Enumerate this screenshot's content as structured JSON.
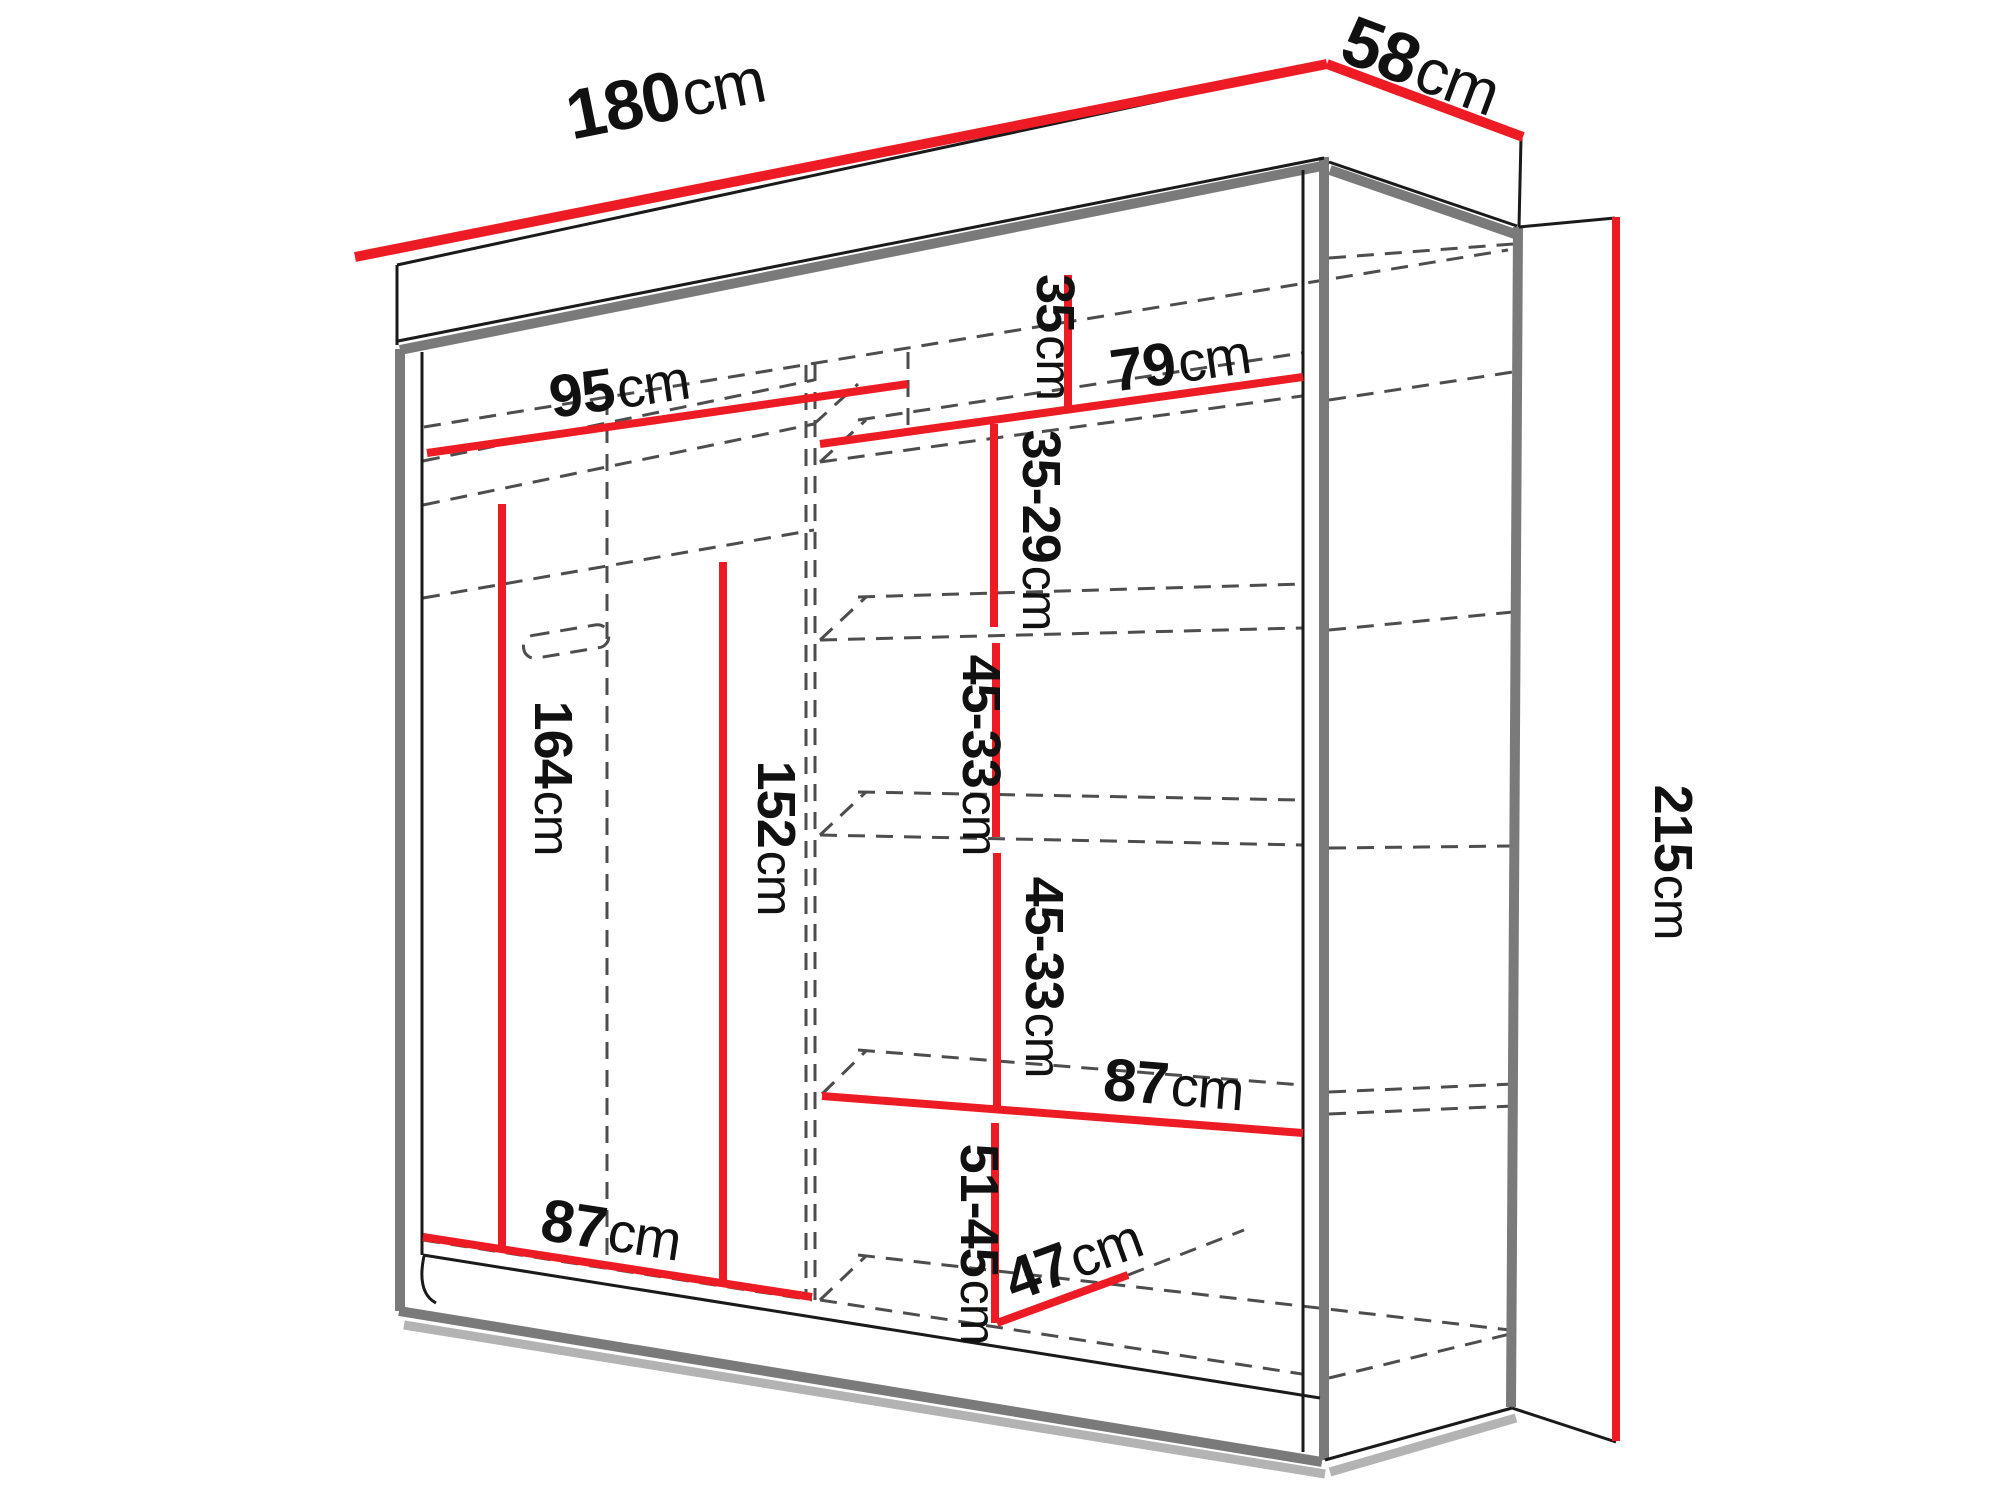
{
  "diagram": {
    "type": "furniture-dimension-drawing",
    "subject": "sliding-door wardrobe with interior shelves and hanging rails",
    "unit": "cm",
    "colors": {
      "dimension_line": "#ed1c24",
      "outline": "#1a1a1a",
      "panel_trim": "#7a7a7a",
      "hidden_edge": "#4d4d4d",
      "background": "#ffffff"
    },
    "dimensions": {
      "overall_width": {
        "num": "180",
        "unit": "cm"
      },
      "overall_depth": {
        "num": "58",
        "unit": "cm"
      },
      "overall_height": {
        "num": "215",
        "unit": "cm"
      },
      "left_section_width": {
        "num": "95",
        "unit": "cm"
      },
      "right_top_shelf_width": {
        "num": "79",
        "unit": "cm"
      },
      "right_top_height": {
        "num": "35",
        "unit": "cm"
      },
      "right_gap_upper": {
        "num": "35-29",
        "unit": "cm"
      },
      "right_gap_mid_1": {
        "num": "45-33",
        "unit": "cm"
      },
      "right_gap_mid_2": {
        "num": "45-33",
        "unit": "cm"
      },
      "right_shelf_width": {
        "num": "87",
        "unit": "cm"
      },
      "right_gap_bottom": {
        "num": "51-45",
        "unit": "cm"
      },
      "bottom_shelf_depth": {
        "num": "47",
        "unit": "cm"
      },
      "left_bottom_width": {
        "num": "87",
        "unit": "cm"
      },
      "left_hanging_height": {
        "num": "164",
        "unit": "cm"
      },
      "middle_hanging_height": {
        "num": "152",
        "unit": "cm"
      }
    }
  }
}
